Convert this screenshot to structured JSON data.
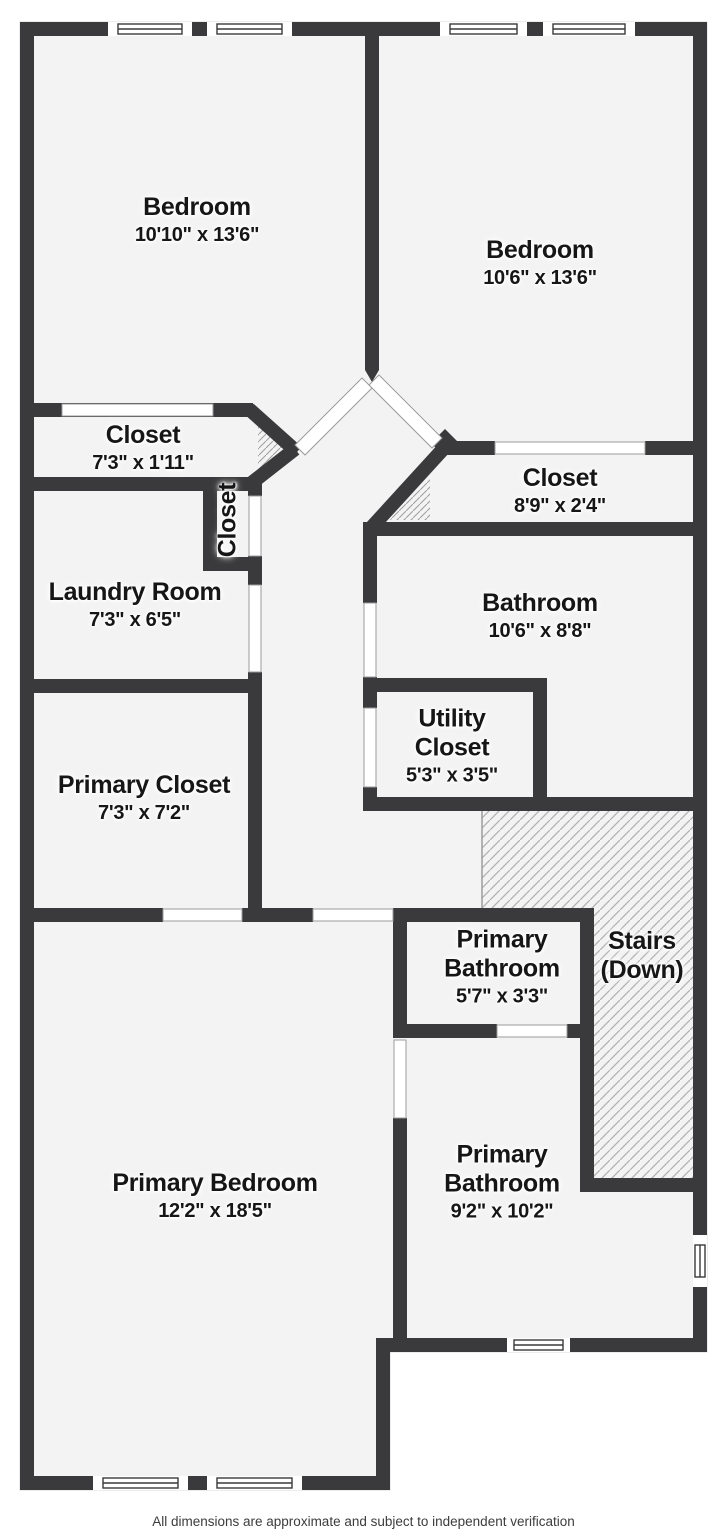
{
  "palette": {
    "wall": "#3a3a3c",
    "floor": "#f3f3f3",
    "hatch_line": "#b2b2b2",
    "door_outline": "#9b9b9b",
    "label_text": "#161616",
    "footer_text": "#3c3c3c"
  },
  "footer": "All dimensions are approximate and subject to independent verification",
  "rooms": [
    {
      "id": "bedroom-1",
      "cx": 197,
      "cy": 221,
      "lines": [
        {
          "t": "Bedroom",
          "s": "name"
        },
        {
          "t": "10'10\" x 13'6\"",
          "s": "dims"
        }
      ]
    },
    {
      "id": "bedroom-2",
      "cx": 540,
      "cy": 264,
      "lines": [
        {
          "t": "Bedroom",
          "s": "name"
        },
        {
          "t": "10'6\" x 13'6\"",
          "s": "dims"
        }
      ]
    },
    {
      "id": "closet-1",
      "cx": 143,
      "cy": 449,
      "lines": [
        {
          "t": "Closet",
          "s": "name"
        },
        {
          "t": "7'3\" x 1'11\"",
          "s": "dims"
        }
      ]
    },
    {
      "id": "hall-closet",
      "cx": 228,
      "cy": 520,
      "rotate": -90,
      "lines": [
        {
          "t": "Closet",
          "s": "name"
        }
      ]
    },
    {
      "id": "laundry-room",
      "cx": 135,
      "cy": 606,
      "lines": [
        {
          "t": "Laundry Room",
          "s": "name"
        },
        {
          "t": "7'3\" x 6'5\"",
          "s": "dims"
        }
      ]
    },
    {
      "id": "closet-2",
      "cx": 560,
      "cy": 492,
      "lines": [
        {
          "t": "Closet",
          "s": "name"
        },
        {
          "t": "8'9\" x 2'4\"",
          "s": "dims"
        }
      ]
    },
    {
      "id": "bathroom",
      "cx": 540,
      "cy": 617,
      "lines": [
        {
          "t": "Bathroom",
          "s": "name"
        },
        {
          "t": "10'6\" x 8'8\"",
          "s": "dims"
        }
      ]
    },
    {
      "id": "utility-closet",
      "cx": 452,
      "cy": 747,
      "lines": [
        {
          "t": "Utility",
          "s": "name"
        },
        {
          "t": "Closet",
          "s": "name"
        },
        {
          "t": "5'3\" x 3'5\"",
          "s": "dims"
        }
      ]
    },
    {
      "id": "primary-closet",
      "cx": 144,
      "cy": 799,
      "lines": [
        {
          "t": "Primary Closet",
          "s": "name"
        },
        {
          "t": "7'3\" x 7'2\"",
          "s": "dims"
        }
      ]
    },
    {
      "id": "primary-bathroom-1",
      "cx": 502,
      "cy": 968,
      "lines": [
        {
          "t": "Primary",
          "s": "name"
        },
        {
          "t": "Bathroom",
          "s": "name"
        },
        {
          "t": "5'7\" x 3'3\"",
          "s": "dims"
        }
      ]
    },
    {
      "id": "stairs",
      "cx": 642,
      "cy": 956,
      "lines": [
        {
          "t": "Stairs",
          "s": "name"
        },
        {
          "t": "(Down)",
          "s": "name"
        }
      ]
    },
    {
      "id": "primary-bedroom",
      "cx": 215,
      "cy": 1197,
      "lines": [
        {
          "t": "Primary Bedroom",
          "s": "name"
        },
        {
          "t": "12'2\" x 18'5\"",
          "s": "dims"
        }
      ]
    },
    {
      "id": "primary-bathroom-2",
      "cx": 502,
      "cy": 1183,
      "lines": [
        {
          "t": "Primary",
          "s": "name"
        },
        {
          "t": "Bathroom",
          "s": "name"
        },
        {
          "t": "9'2\" x 10'2\"",
          "s": "dims"
        }
      ]
    }
  ]
}
